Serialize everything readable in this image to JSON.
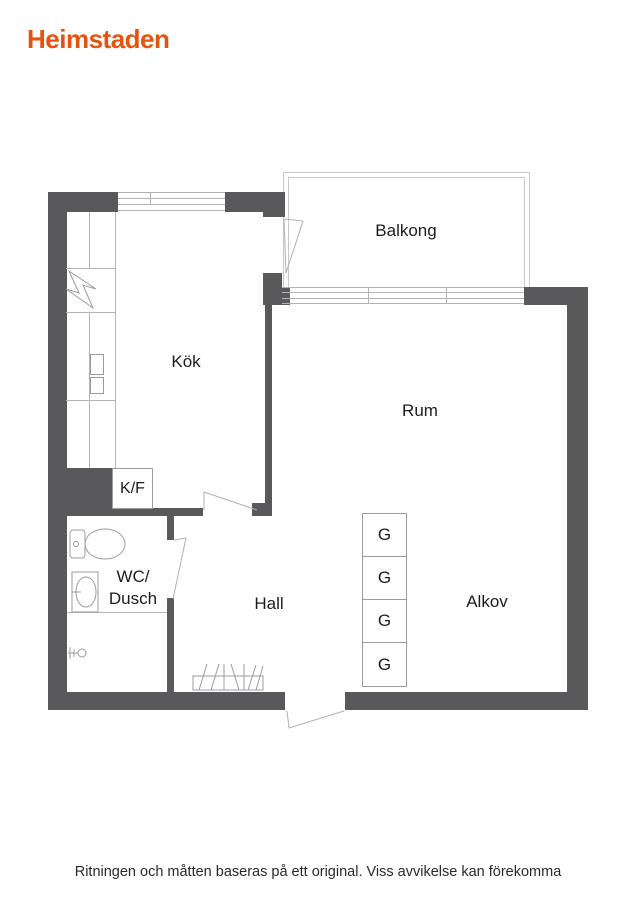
{
  "brand": {
    "logo_text": "Heimstaden",
    "logo_color": "#e7530f"
  },
  "plan": {
    "wall_color": "#59595b",
    "thin_line_color": "#b3b3b3",
    "symbol_line_color": "#9c9c9c",
    "rooms": {
      "balkong": "Balkong",
      "kok": "Kök",
      "rum": "Rum",
      "hall": "Hall",
      "alkov": "Alkov",
      "wc_line1": "WC/",
      "wc_line2": "Dusch",
      "kf": "K/F"
    },
    "closets": [
      "G",
      "G",
      "G",
      "G"
    ],
    "symbols": [
      "stove-icon",
      "sink-unit-icon",
      "toilet-icon",
      "washbasin-icon",
      "shower-mixer-icon",
      "coat-rack-icon",
      "door-swing-icon",
      "window-icon"
    ]
  },
  "footer": {
    "disclaimer": "Ritningen och måtten baseras på ett original. Viss avvikelse kan förekomma"
  }
}
